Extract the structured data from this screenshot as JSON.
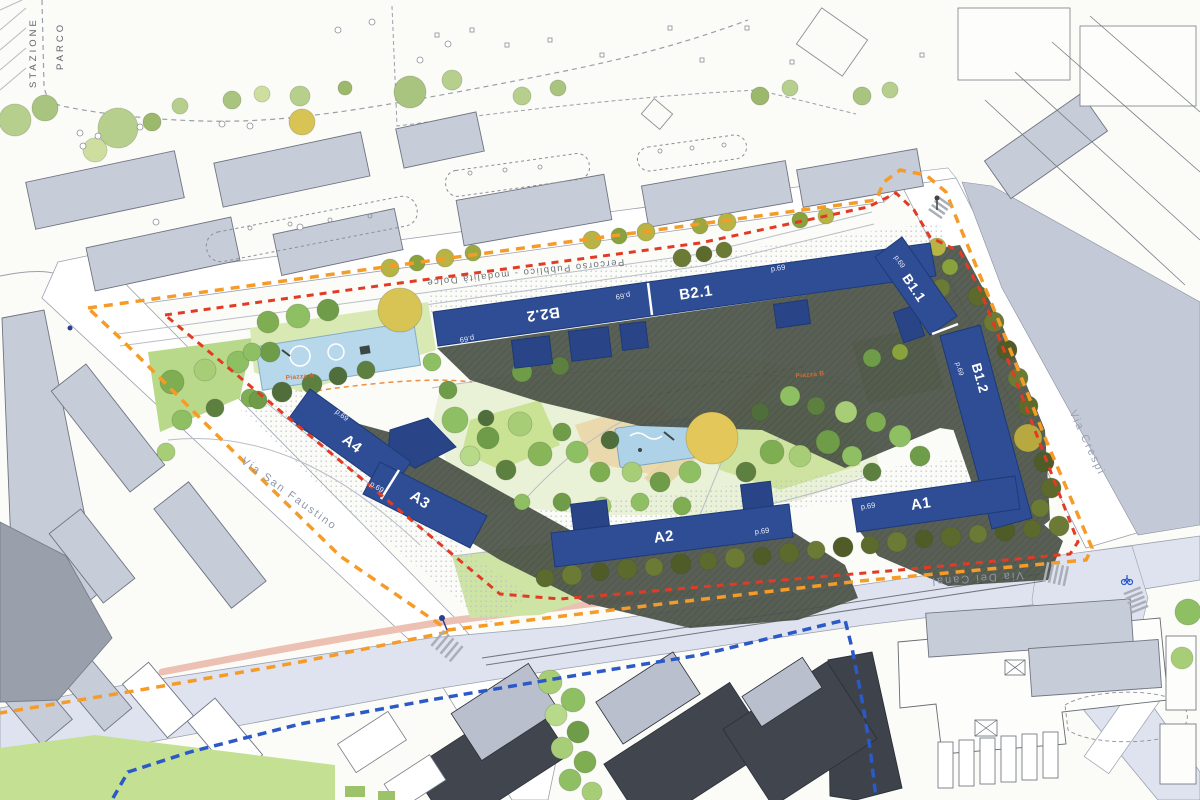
{
  "plan": {
    "park_area_label": "PARCO STAZIONE",
    "public_path_label": "Percorso Pubblico - modalità Dolce",
    "plaza_a_label": "Piazza A",
    "plaza_b_label": "Piazza B"
  },
  "streets": [
    {
      "name": "Via San Faustino"
    },
    {
      "name": "Via Dei Canal"
    },
    {
      "name": "Via Crespi"
    }
  ],
  "buildings": [
    {
      "id": "A1",
      "label": "A1",
      "note": "p.69"
    },
    {
      "id": "A2",
      "label": "A2",
      "note": "p.69"
    },
    {
      "id": "A3",
      "label": "A3",
      "note": "p.69"
    },
    {
      "id": "A4",
      "label": "A4",
      "note": "p.69"
    },
    {
      "id": "B1.1",
      "label": "B1.1",
      "note": "p.69"
    },
    {
      "id": "B1.2",
      "label": "B1.2",
      "note": "p.69"
    },
    {
      "id": "B2.1",
      "label": "B2.1",
      "note": "p.69"
    },
    {
      "id": "B2.2",
      "label": "B2.2",
      "note": "p.69"
    }
  ],
  "boundaries": [
    {
      "id": "perimeter-orange",
      "style": "dashed",
      "color": "#f59b28"
    },
    {
      "id": "perimeter-red",
      "style": "dashed",
      "color": "#e23b25"
    },
    {
      "id": "perimeter-blue",
      "style": "dashed",
      "color": "#2b59c8"
    }
  ],
  "palette": {
    "new_building_blue": "#2e4d95",
    "existing_building_gray": "#c6ccd8",
    "shadow_green_gray": "#4d5449",
    "lawn_green": "#c9e294",
    "tree_olive": "#6b7a35",
    "road_lavender": "#dfe3f0"
  }
}
